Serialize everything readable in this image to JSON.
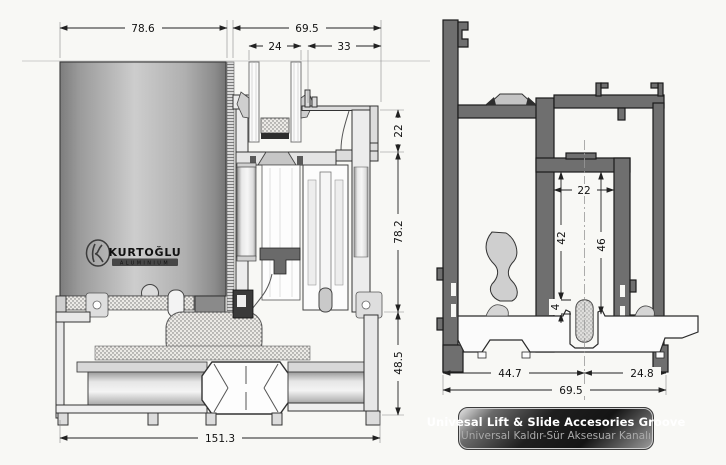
{
  "page": {
    "background": "#f8f8f5"
  },
  "left_section": {
    "dims": {
      "overall_top_left": "78.6",
      "overall_top_right": "69.5",
      "glass_pocket": "24",
      "frame_top": "33",
      "head_height": "22",
      "sash_height": "78.2",
      "sill_height": "48.5",
      "overall_bottom": "151.3"
    },
    "logo": {
      "brand": "KURTOĞLU",
      "subtitle": "ALUMINIUM"
    }
  },
  "right_section": {
    "dims": {
      "groove_width": "22",
      "groove_depth": "42",
      "groove_total_depth": "46",
      "track_lip": "4",
      "sill_left": "44.7",
      "sill_right": "24.8",
      "overall_bottom": "69.5"
    }
  },
  "caption": {
    "title": "Univesal Lift & Slide Accesories Groove",
    "subtitle": "Universal Kaldır-Sür Aksesuar Kanalı"
  },
  "colors": {
    "profile_dark": "#6f6f6f",
    "line": "#222222",
    "caption_text": "#ffffff",
    "caption_subtext": "#a9a9a9"
  }
}
